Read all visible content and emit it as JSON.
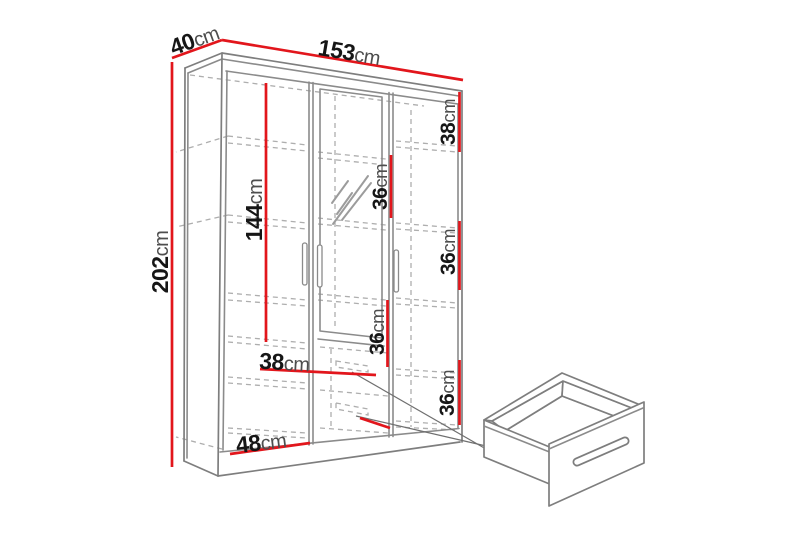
{
  "colors": {
    "dimension_red": "#e2161c",
    "line_gray": "#8b8b8b",
    "hidden_line_gray": "#aeaeae",
    "number_black": "#161616",
    "unit_gray": "#4e4e4e",
    "background": "#ffffff"
  },
  "diagram": {
    "subject": "three-door wardrobe with mirror and two drawers",
    "dimensions": {
      "depth": {
        "value": "40",
        "unit": "cm"
      },
      "width": {
        "value": "153",
        "unit": "cm"
      },
      "height": {
        "value": "202",
        "unit": "cm"
      },
      "hanging_space": {
        "value": "144",
        "unit": "cm"
      },
      "top_section": {
        "value": "38",
        "unit": "cm"
      },
      "upper_section": {
        "value": "36",
        "unit": "cm"
      },
      "middle_section": {
        "value": "36",
        "unit": "cm"
      },
      "drawer_section": {
        "value": "36",
        "unit": "cm"
      },
      "bottom_section": {
        "value": "36",
        "unit": "cm"
      },
      "shelf_width": {
        "value": "38",
        "unit": "cm"
      },
      "left_section_width": {
        "value": "48",
        "unit": "cm"
      }
    }
  }
}
